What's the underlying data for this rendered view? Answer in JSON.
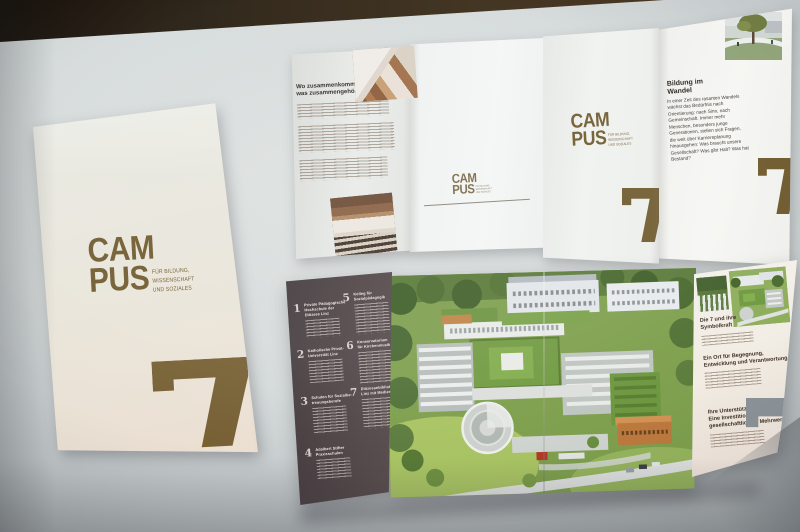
{
  "scene": {
    "description": "Photograph of the CAMPUS 7 brochure set (cover, unfolded outside spread, unfolded inside spread) on a bright surface"
  },
  "brand": {
    "logo_top": "CAM",
    "logo_bottom": "PUS",
    "tagline_l1": "FÜR BILDUNG,",
    "tagline_l2": "WISSENSCHAFT",
    "tagline_l3": "UND SOZIALES",
    "numeral": "7"
  },
  "top_brochure": {
    "left_panel": {
      "heading_l1": "Wo zusammenkommt,",
      "heading_l2": "was zusammengehört"
    },
    "right_panel": {
      "heading_l1": "Bildung im",
      "heading_l2": "Wandel",
      "body": "In einer Zeit des rasanten Wandels wächst das Bedürfnis nach Orientierung: nach Sinn, nach Gemeinschaft. Immer mehr Menschen, besonders junge Generationen, stellen sich Fragen, die weit über Karriereplanung hinausgehen: Was braucht unsere Gesellschaft? Was gibt Halt? Was hat Bestand?"
    }
  },
  "bottom_brochure": {
    "institutions": [
      {
        "num": "1",
        "lines": [
          "Private Pädagogische",
          "Hochschule der",
          "Diözese Linz"
        ]
      },
      {
        "num": "2",
        "lines": [
          "Katholische Privat-",
          "Universität Linz"
        ]
      },
      {
        "num": "3",
        "lines": [
          "Schulen für Sozialbe-",
          "treuungsberufe"
        ]
      },
      {
        "num": "4",
        "lines": [
          "Adalbert Stifter",
          "Praxisschulen"
        ]
      },
      {
        "num": "5",
        "lines": [
          "Kolleg für",
          "Sozialpädagogik"
        ]
      },
      {
        "num": "6",
        "lines": [
          "Konservatorium",
          "für Kirchenmusik"
        ]
      },
      {
        "num": "7",
        "lines": [
          "Diözesanbibliothek",
          "Linz mit Medienverleih"
        ]
      }
    ],
    "info_panel": {
      "sections": [
        {
          "lines": [
            "Die 7 und ihre",
            "Symbolkraft"
          ]
        },
        {
          "lines": [
            "Ein Ort für Begegnung,",
            "Entwicklung und Verantwortung"
          ]
        },
        {
          "lines": [
            "Ihre Unterstützung:",
            "Eine Investition mit",
            "gesellschaftlichem Mehrwert"
          ]
        }
      ]
    }
  },
  "colors": {
    "brand_brown": "#6e592c",
    "numeral_gray": "#8d9499",
    "dark_panel": "#4a4043",
    "cover_cream": "#e9e6dc"
  }
}
